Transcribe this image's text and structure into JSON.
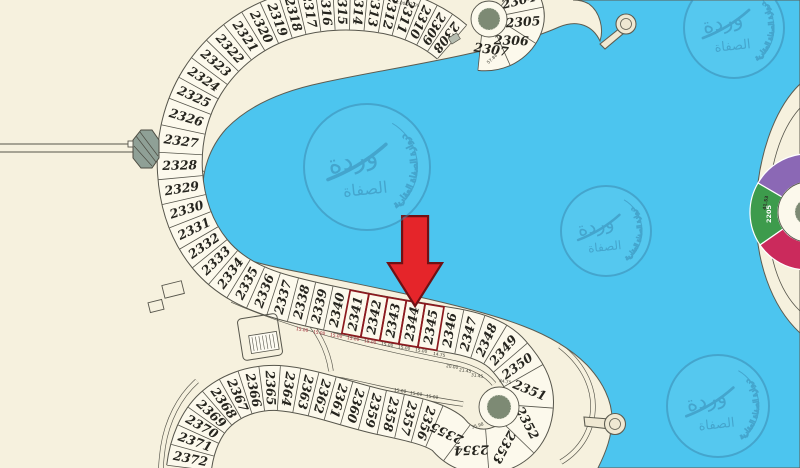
{
  "map": {
    "colors": {
      "water": "#4cc5ef",
      "land": "#f6f1de",
      "plot_fill": "#fcf9ec",
      "line": "#56554b",
      "highlight": "#8c1a1f",
      "arrow": "#e5252a",
      "arrow_border": "#701014",
      "roundabout_green": "#7d8a74",
      "watermark_blue": "#3d87ad",
      "dim_red": "#9d2430",
      "island_purple": "#8b68b5",
      "island_green": "#3d9b4c",
      "island_crimson": "#cb2a5c"
    },
    "arrow": {
      "points_to_plot": "2344"
    },
    "highlighted_plots": [
      "2341",
      "2342",
      "2343",
      "2344",
      "2345"
    ],
    "plots_top_culdesac": [
      {
        "n": "2304",
        "w": 26,
        "rot": -14
      },
      {
        "n": "2305",
        "w": 26,
        "rot": -4
      },
      {
        "n": "2306",
        "w": 26,
        "rot": 2
      },
      {
        "n": "2307",
        "w": 26,
        "rot": 8
      }
    ],
    "plots_main": [
      {
        "n": "2308",
        "w": 15
      },
      {
        "n": "2309",
        "w": 15
      },
      {
        "n": "2310",
        "w": 15
      },
      {
        "n": "2311",
        "w": 16
      },
      {
        "n": "2312",
        "w": 16
      },
      {
        "n": "2313",
        "w": 16
      },
      {
        "n": "2314",
        "w": 16
      },
      {
        "n": "2315",
        "w": 16
      },
      {
        "n": "2316",
        "w": 16
      },
      {
        "n": "2317",
        "w": 17
      },
      {
        "n": "2318",
        "w": 16
      },
      {
        "n": "2319",
        "w": 17
      },
      {
        "n": "2320",
        "w": 18
      },
      {
        "n": "2321",
        "w": 19
      },
      {
        "n": "2322",
        "w": 20
      },
      {
        "n": "2323",
        "w": 20
      },
      {
        "n": "2324",
        "w": 20
      },
      {
        "n": "2325",
        "w": 20
      },
      {
        "n": "2326",
        "w": 24
      },
      {
        "n": "2327",
        "w": 24
      },
      {
        "n": "2328",
        "w": 24
      },
      {
        "n": "2329",
        "w": 22
      },
      {
        "n": "2330",
        "w": 21
      },
      {
        "n": "2331",
        "w": 20
      },
      {
        "n": "2332",
        "w": 19
      },
      {
        "n": "2333",
        "w": 19
      },
      {
        "n": "2334",
        "w": 19
      },
      {
        "n": "2335",
        "w": 19
      },
      {
        "n": "2336",
        "w": 19
      },
      {
        "n": "2337",
        "w": 20
      },
      {
        "n": "2338",
        "w": 18
      },
      {
        "n": "2339",
        "w": 18
      },
      {
        "n": "2340",
        "w": 18
      },
      {
        "n": "2341",
        "w": 19,
        "hl": true
      },
      {
        "n": "2342",
        "w": 19,
        "hl": true
      },
      {
        "n": "2343",
        "w": 19,
        "hl": true
      },
      {
        "n": "2344",
        "w": 19,
        "hl": true,
        "target": true
      },
      {
        "n": "2345",
        "w": 19,
        "hl": true
      },
      {
        "n": "2346",
        "w": 19
      },
      {
        "n": "2347",
        "w": 19
      },
      {
        "n": "2348",
        "w": 19
      },
      {
        "n": "2349",
        "w": 20
      },
      {
        "n": "2350",
        "w": 22
      },
      {
        "n": "2351",
        "w": 32,
        "rot": 22
      },
      {
        "n": "2352",
        "w": 34,
        "rot": 62
      },
      {
        "n": "2353",
        "w": 34,
        "rot": 118
      },
      {
        "n": "2354",
        "w": 32,
        "rot": 178
      },
      {
        "n": "2355",
        "w": 28,
        "rot": 205
      },
      {
        "n": "2356",
        "w": 18
      },
      {
        "n": "2357",
        "w": 18
      },
      {
        "n": "2358",
        "w": 18
      },
      {
        "n": "2359",
        "w": 18
      },
      {
        "n": "2360",
        "w": 18
      },
      {
        "n": "2361",
        "w": 17
      },
      {
        "n": "2362",
        "w": 17
      },
      {
        "n": "2363",
        "w": 17
      },
      {
        "n": "2364",
        "w": 18
      },
      {
        "n": "2365",
        "w": 17
      },
      {
        "n": "2366",
        "w": 17
      },
      {
        "n": "2367",
        "w": 16
      },
      {
        "n": "2368",
        "w": 16
      },
      {
        "n": "2369",
        "w": 16
      },
      {
        "n": "2370",
        "w": 16
      },
      {
        "n": "2371",
        "w": 17
      },
      {
        "n": "2372",
        "w": 18
      }
    ],
    "dims": [
      {
        "t": "12.00",
        "x": 399,
        "y": 4,
        "r": 10
      },
      {
        "t": "12.00",
        "x": 413,
        "y": 6,
        "r": 10
      },
      {
        "t": "57.84",
        "x": 493,
        "y": 60,
        "r": -42
      },
      {
        "t": "15.00",
        "x": 302,
        "y": 331,
        "r": 9,
        "red": true
      },
      {
        "t": "15.00",
        "x": 319,
        "y": 334,
        "r": 9,
        "red": true
      },
      {
        "t": "15.00",
        "x": 336,
        "y": 337,
        "r": 9,
        "red": true
      },
      {
        "t": "15.00",
        "x": 353,
        "y": 340,
        "r": 9,
        "red": true
      },
      {
        "t": "15.00",
        "x": 370,
        "y": 343,
        "r": 9,
        "red": true
      },
      {
        "t": "15.00",
        "x": 387,
        "y": 346,
        "r": 9
      },
      {
        "t": "15.00",
        "x": 404,
        "y": 349,
        "r": 9
      },
      {
        "t": "15.00",
        "x": 421,
        "y": 352,
        "r": 9
      },
      {
        "t": "14.75",
        "x": 439,
        "y": 356,
        "r": 10
      },
      {
        "t": "20.00",
        "x": 452,
        "y": 368,
        "r": 8
      },
      {
        "t": "21.45",
        "x": 465,
        "y": 372,
        "r": 8
      },
      {
        "t": "31.45",
        "x": 477,
        "y": 377,
        "r": 8
      },
      {
        "t": "34.75",
        "x": 505,
        "y": 383,
        "r": 10
      },
      {
        "t": "35.98",
        "x": 478,
        "y": 427,
        "r": -18
      },
      {
        "t": "15.00",
        "x": 400,
        "y": 392,
        "r": 8
      },
      {
        "t": "15.00",
        "x": 416,
        "y": 395,
        "r": 8
      },
      {
        "t": "15.00",
        "x": 432,
        "y": 398,
        "r": 8
      }
    ],
    "watermark": {
      "text_big_1": "وردة",
      "text_big_2": "الصفاة",
      "text_ring": "دروازة الصفاة العقارية"
    },
    "watermarks": [
      {
        "cx": 367,
        "cy": 167,
        "r": 63
      },
      {
        "cx": 606,
        "cy": 231,
        "r": 45
      },
      {
        "cx": 734,
        "cy": 28,
        "r": 50
      },
      {
        "cx": 718,
        "cy": 406,
        "r": 51
      }
    ],
    "right_island_labels": [
      {
        "t": "2205",
        "x": 771,
        "y": 214,
        "r": -90,
        "fill": "#ffffff",
        "s": 6.5
      },
      {
        "t": "41.53",
        "x": 767,
        "y": 203,
        "r": -80,
        "fill": "#2e2e28",
        "s": 4.5
      }
    ]
  }
}
